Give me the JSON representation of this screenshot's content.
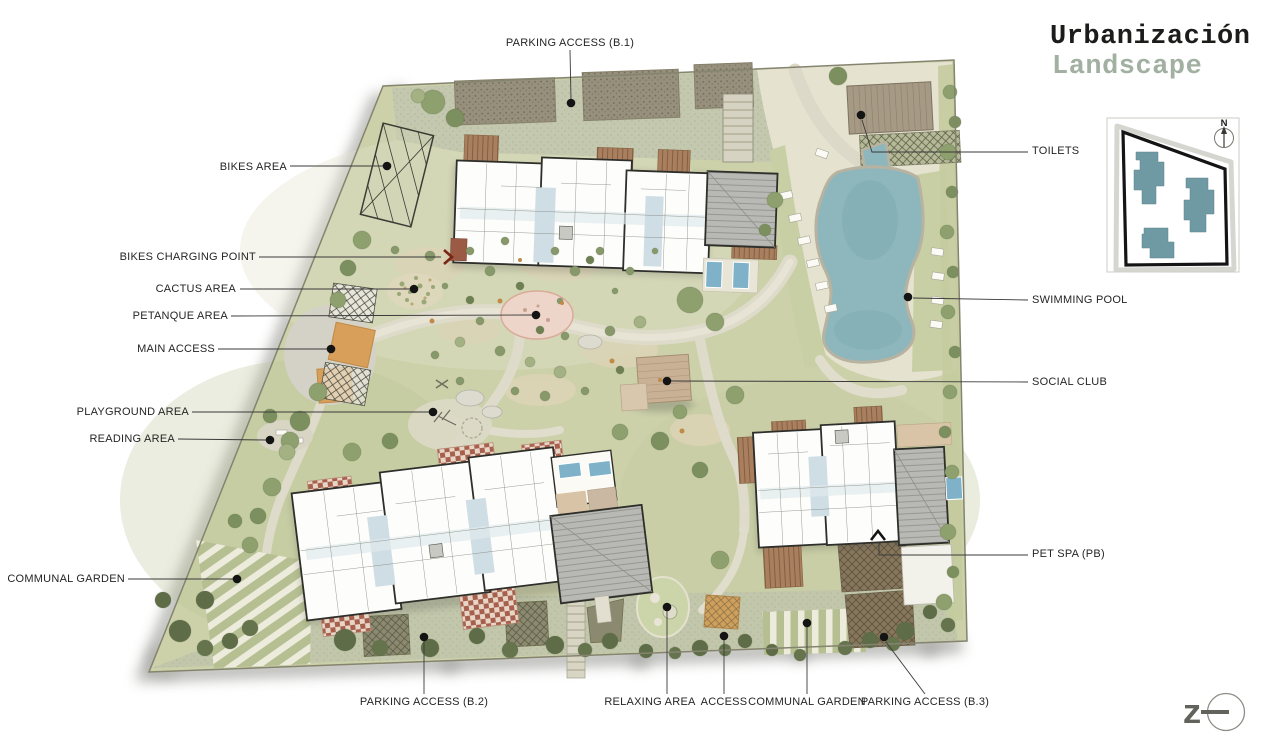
{
  "title": {
    "line1": "Urbanización",
    "line2": "Landscape"
  },
  "callouts": {
    "top": [
      {
        "label": "PARKING ACCESS (B.1)",
        "marker": "dot"
      }
    ],
    "left": [
      {
        "label": "BIKES AREA",
        "marker": "dot"
      },
      {
        "label": "BIKES CHARGING POINT",
        "marker": "chevron-right"
      },
      {
        "label": "CACTUS AREA",
        "marker": "dot"
      },
      {
        "label": "PETANQUE AREA",
        "marker": "dot"
      },
      {
        "label": "MAIN ACCESS",
        "marker": "dot"
      },
      {
        "label": "PLAYGROUND AREA",
        "marker": "dot"
      },
      {
        "label": "READING AREA",
        "marker": "dot"
      },
      {
        "label": "COMMUNAL GARDEN",
        "marker": "dot"
      }
    ],
    "right": [
      {
        "label": "TOILETS",
        "marker": "dot"
      },
      {
        "label": "SWIMMING POOL",
        "marker": "dot"
      },
      {
        "label": "SOCIAL CLUB",
        "marker": "dot"
      },
      {
        "label": "PET SPA (PB)",
        "marker": "chevron-up"
      }
    ],
    "bottom": [
      {
        "label": "PARKING ACCESS (B.2)",
        "marker": "dot"
      },
      {
        "label": "RELAXING AREA",
        "marker": "dot"
      },
      {
        "label": "ACCESS",
        "marker": "dot"
      },
      {
        "label": "COMMUNAL GARDEN",
        "marker": "dot"
      },
      {
        "label": "PARKING ACCESS (B.3)",
        "marker": "dot"
      }
    ]
  },
  "inset_map": {
    "compass_label": "N"
  },
  "logo": {
    "letter": "z"
  },
  "colors": {
    "title_primary": "#1c1c1a",
    "title_secondary": "#a2b0a2",
    "label_text": "#252525",
    "leader_line": "#3a3a3a",
    "site_green": "#ccd1aa",
    "pool_blue": "#8db7bc",
    "wood_deck": "#a97f5f",
    "red_deck": "#a8604e",
    "inset_building_teal": "#6f9aa4"
  }
}
